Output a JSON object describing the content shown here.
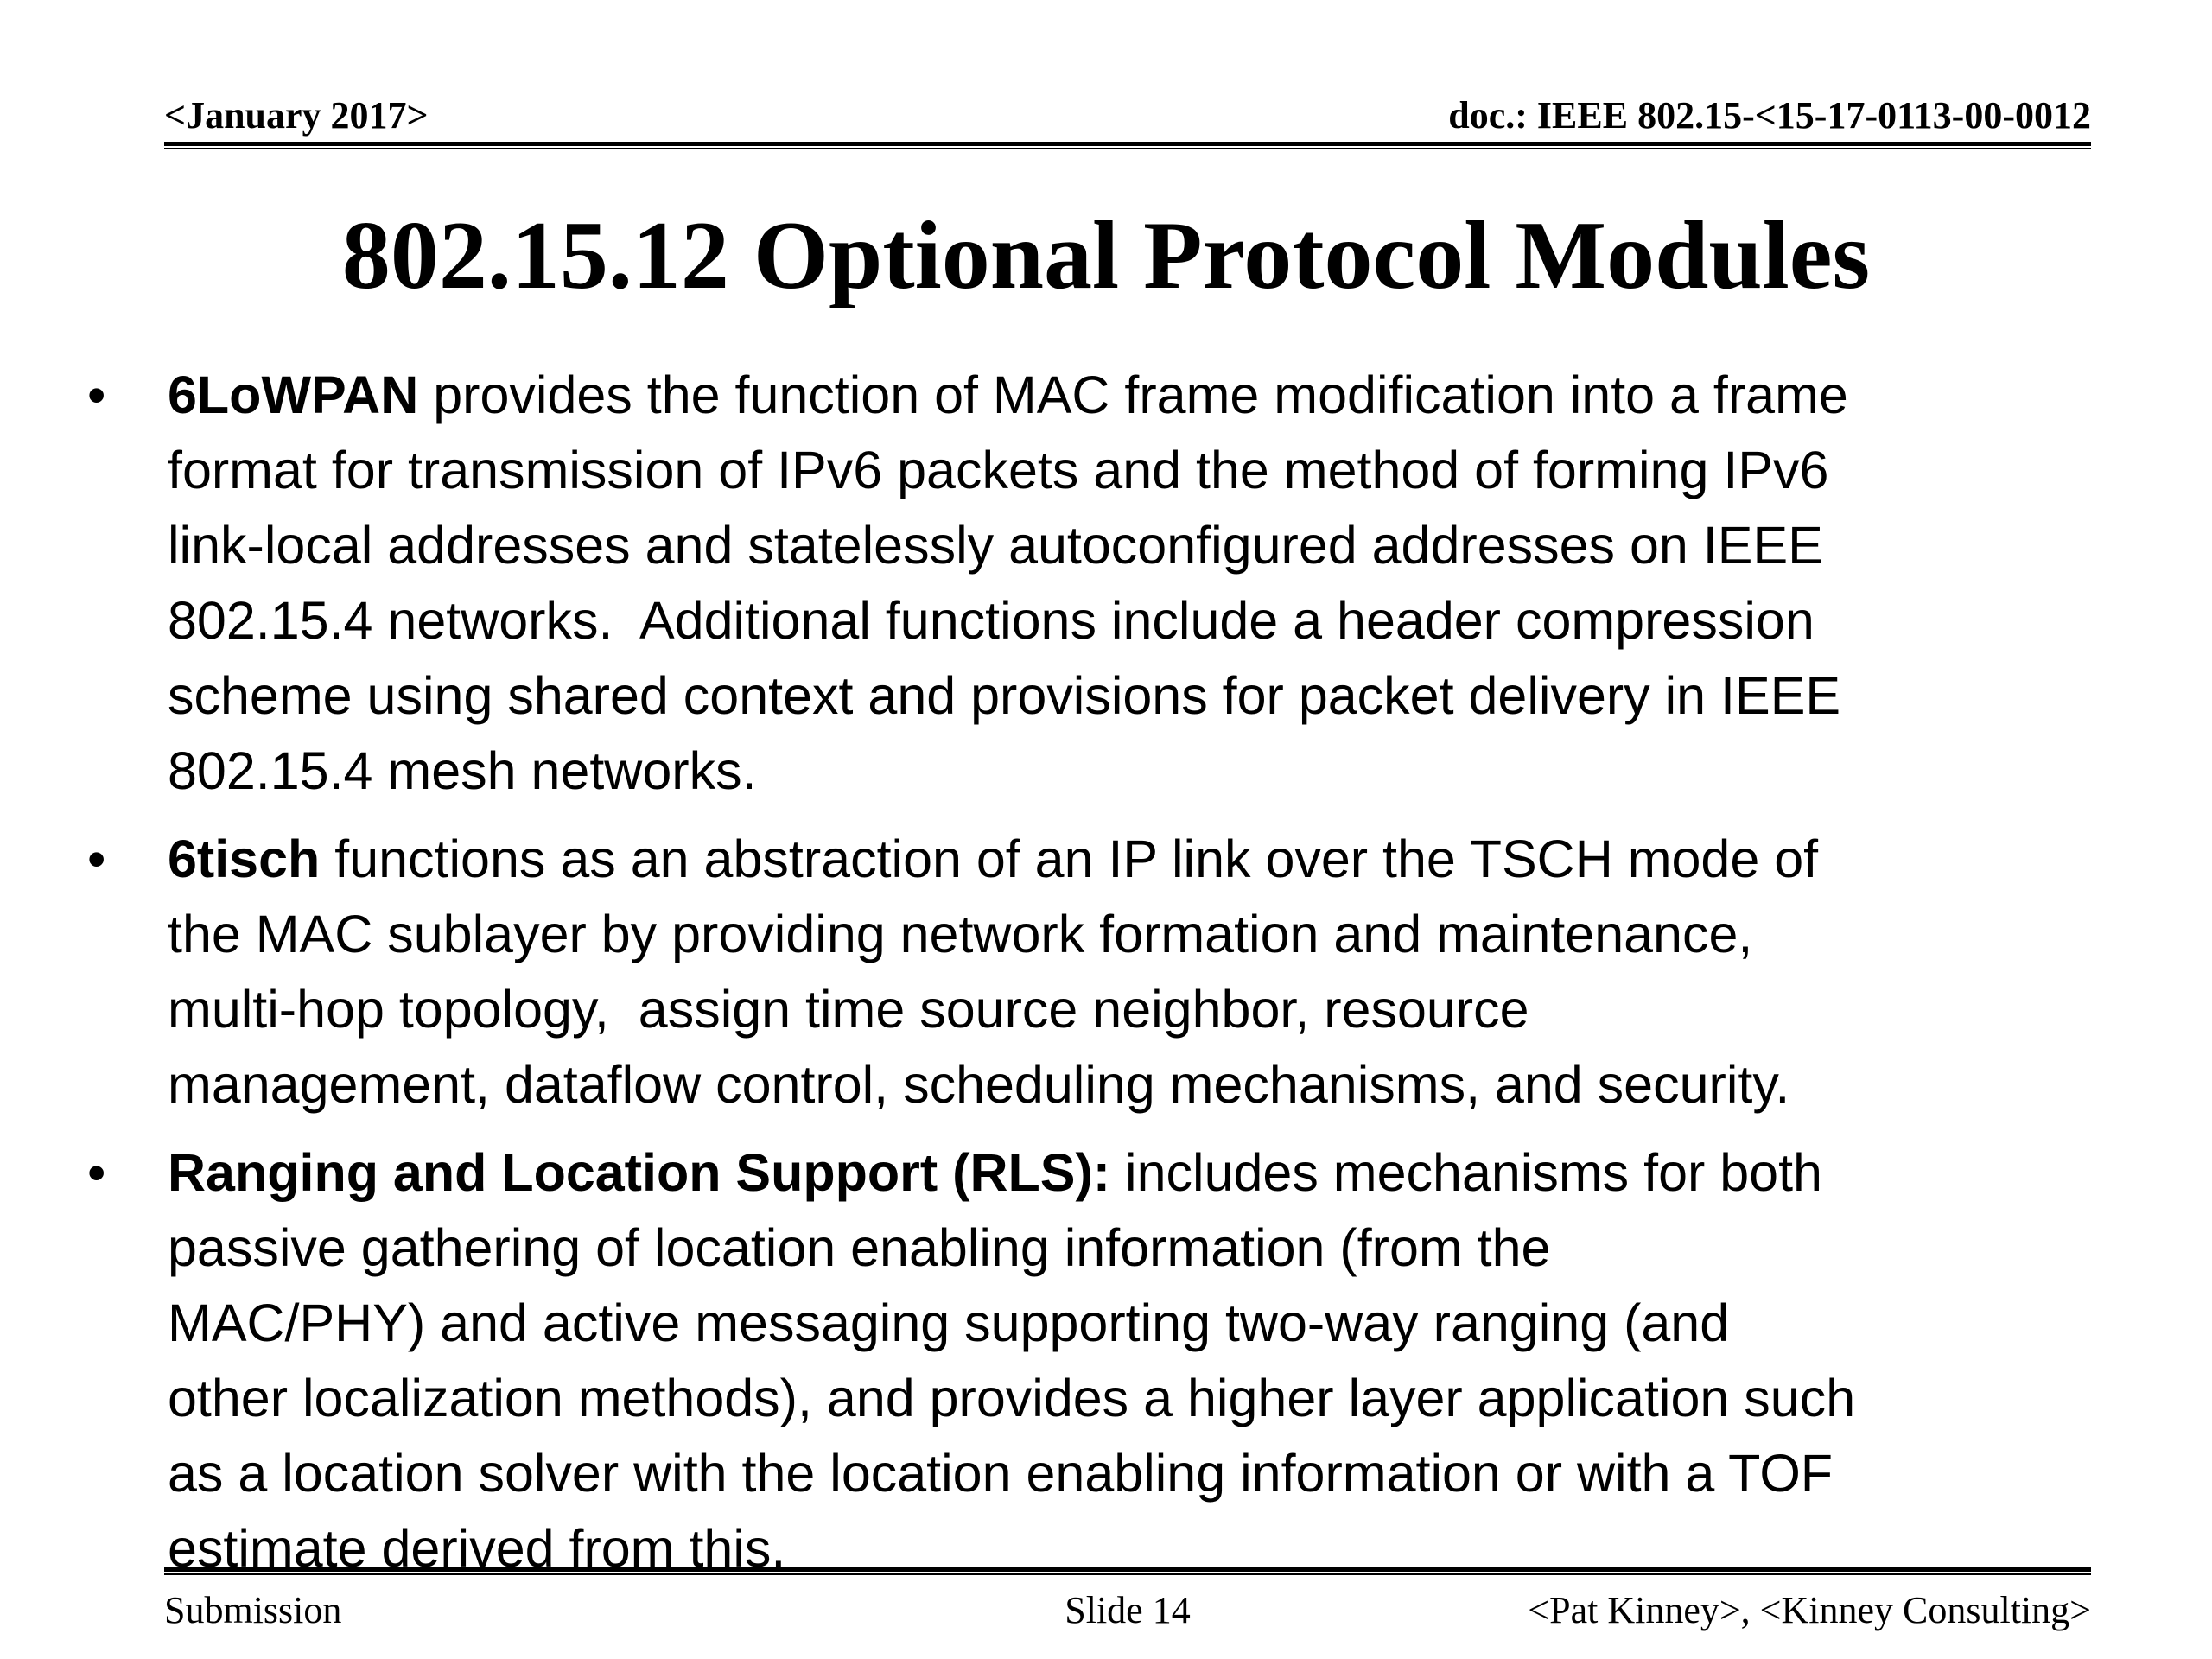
{
  "page": {
    "background_color": "#ffffff",
    "text_color": "#000000",
    "rule_color": "#000000"
  },
  "header": {
    "date": "<January 2017>",
    "doc": "doc.: IEEE 802.15-<15-17-0113-00-0012"
  },
  "title": "802.15.12 Optional Protocol Modules",
  "bullets": [
    {
      "marker": "•",
      "bold": "6LoWPAN",
      "text": " provides the function of MAC frame modification into a frame\nformat for transmission of IPv6 packets and the method of forming IPv6\nlink-local addresses and statelessly autoconfigured addresses on IEEE\n802.15.4 networks.  Additional functions include a header compression\nscheme using shared context and provisions for packet delivery in IEEE\n802.15.4 mesh networks."
    },
    {
      "marker": "•",
      "bold": "6tisch",
      "text": " functions as an abstraction of an IP link over the TSCH mode of\nthe MAC sublayer by providing network formation and maintenance,\nmulti-hop topology,  assign time source neighbor, resource\nmanagement, dataflow control, scheduling mechanisms, and security."
    },
    {
      "marker": "•",
      "bold": "Ranging and Location Support (RLS):",
      "text": " includes mechanisms for both\npassive gathering of location enabling information (from the\nMAC/PHY) and active messaging supporting two-way ranging (and\nother localization methods), and provides a higher layer application such\nas a location solver with the location enabling information or with a TOF\nestimate derived from this."
    }
  ],
  "footer": {
    "left": "Submission",
    "center": "Slide 14",
    "right": "<Pat Kinney>, <Kinney Consulting>"
  }
}
